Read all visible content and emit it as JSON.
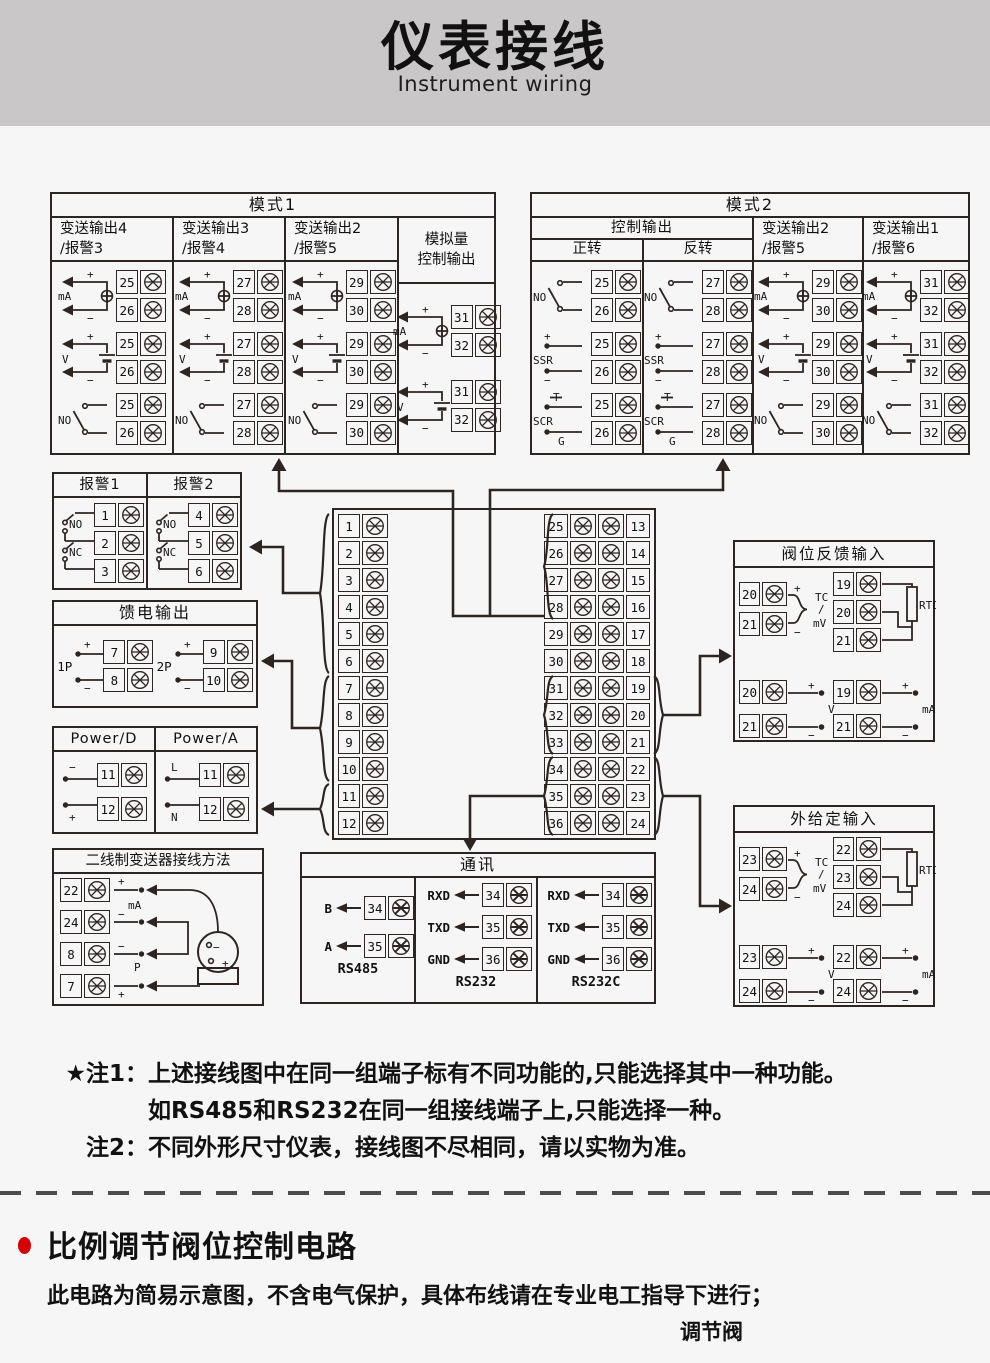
{
  "header": {
    "title": "仪表接线",
    "subtitle": "Instrument wiring"
  },
  "mode1": {
    "title": "模式1",
    "columns": [
      {
        "line1": "变送输出4",
        "line2": "/报警3",
        "cells": [
          {
            "type": "mA",
            "t": [
              "25",
              "26"
            ]
          },
          {
            "type": "V",
            "t": [
              "25",
              "26"
            ]
          },
          {
            "type": "NO",
            "t": [
              "25",
              "26"
            ]
          }
        ]
      },
      {
        "line1": "变送输出3",
        "line2": "/报警4",
        "cells": [
          {
            "type": "mA",
            "t": [
              "27",
              "28"
            ]
          },
          {
            "type": "V",
            "t": [
              "27",
              "28"
            ]
          },
          {
            "type": "NO",
            "t": [
              "27",
              "28"
            ]
          }
        ]
      },
      {
        "line1": "变送输出2",
        "line2": "/报警5",
        "cells": [
          {
            "type": "mA",
            "t": [
              "29",
              "30"
            ]
          },
          {
            "type": "V",
            "t": [
              "29",
              "30"
            ]
          },
          {
            "type": "NO",
            "t": [
              "29",
              "30"
            ]
          }
        ]
      },
      {
        "line1": "模拟量",
        "line2": "控制输出",
        "cells": [
          {
            "type": "mA",
            "t": [
              "31",
              "32"
            ]
          },
          {
            "type": "V",
            "t": [
              "31",
              "32"
            ]
          }
        ]
      }
    ]
  },
  "mode2": {
    "title": "模式2",
    "group": "控制输出",
    "columns": [
      {
        "line1": "正转",
        "cells": [
          {
            "type": "NO",
            "t": [
              "25",
              "26"
            ]
          },
          {
            "type": "SSR",
            "t": [
              "25",
              "26"
            ]
          },
          {
            "type": "SCR",
            "t": [
              "25",
              "26"
            ]
          }
        ]
      },
      {
        "line1": "反转",
        "cells": [
          {
            "type": "NO",
            "t": [
              "27",
              "28"
            ]
          },
          {
            "type": "SSR",
            "t": [
              "27",
              "28"
            ]
          },
          {
            "type": "SCR",
            "t": [
              "27",
              "28"
            ]
          }
        ]
      },
      {
        "line1": "变送输出2",
        "line2": "/报警5",
        "cells": [
          {
            "type": "mA",
            "t": [
              "29",
              "30"
            ]
          },
          {
            "type": "V",
            "t": [
              "29",
              "30"
            ]
          },
          {
            "type": "NO",
            "t": [
              "29",
              "30"
            ]
          }
        ]
      },
      {
        "line1": "变送输出1",
        "line2": "/报警6",
        "cells": [
          {
            "type": "mA",
            "t": [
              "31",
              "32"
            ]
          },
          {
            "type": "V",
            "t": [
              "31",
              "32"
            ]
          },
          {
            "type": "NO",
            "t": [
              "31",
              "32"
            ]
          }
        ]
      }
    ]
  },
  "alarm": {
    "no_label": "NO",
    "nc_label": "NC",
    "columns": [
      {
        "title": "报警1",
        "t": [
          "1",
          "2",
          "3"
        ]
      },
      {
        "title": "报警2",
        "t": [
          "4",
          "5",
          "6"
        ]
      }
    ]
  },
  "feed": {
    "title": "馈电输出",
    "groups": [
      {
        "label": "1P",
        "t": [
          "7",
          "8"
        ]
      },
      {
        "label": "2P",
        "t": [
          "9",
          "10"
        ]
      }
    ]
  },
  "power": {
    "columns": [
      {
        "title": "Power/D",
        "signs": [
          "−",
          "+"
        ],
        "t": [
          "11",
          "12"
        ]
      },
      {
        "title": "Power/A",
        "signs": [
          "L",
          "N"
        ],
        "t": [
          "11",
          "12"
        ]
      }
    ]
  },
  "twowire": {
    "title": "二线制变送器接线方法",
    "t": [
      "22",
      "24",
      "8",
      "7"
    ],
    "signs": [
      "+",
      "−",
      "−",
      "+"
    ],
    "labels": [
      "mA",
      "P"
    ]
  },
  "strip": {
    "left": [
      "1",
      "2",
      "3",
      "4",
      "5",
      "6",
      "7",
      "8",
      "9",
      "10",
      "11",
      "12"
    ],
    "mid": [
      "25",
      "26",
      "27",
      "28",
      "29",
      "30",
      "31",
      "32",
      "33",
      "34",
      "35",
      "36"
    ],
    "right": [
      "13",
      "14",
      "15",
      "16",
      "17",
      "18",
      "19",
      "20",
      "21",
      "22",
      "23",
      "24"
    ]
  },
  "valvefb": {
    "title": "阀位反馈输入",
    "tc": {
      "t": [
        "20",
        "21"
      ],
      "label1": "TC",
      "label2": "mV"
    },
    "rtd": {
      "t": [
        "19",
        "20",
        "21"
      ],
      "label": "RTD"
    },
    "v": {
      "t": [
        "20",
        "21"
      ],
      "label": "V"
    },
    "ma": {
      "t": [
        "19",
        "21"
      ],
      "label": "mA"
    }
  },
  "extset": {
    "title": "外给定输入",
    "tc": {
      "t": [
        "23",
        "24"
      ],
      "label1": "TC",
      "label2": "mV"
    },
    "rtd": {
      "t": [
        "22",
        "23",
        "24"
      ],
      "label": "RTD"
    },
    "v": {
      "t": [
        "23",
        "24"
      ],
      "label": "V"
    },
    "ma": {
      "t": [
        "22",
        "24"
      ],
      "label": "mA"
    }
  },
  "comm": {
    "title": "通讯",
    "groups": [
      {
        "name": "RS485",
        "pins": [
          {
            "label": "B",
            "t": "34"
          },
          {
            "label": "A",
            "t": "35"
          }
        ]
      },
      {
        "name": "RS232",
        "pins": [
          {
            "label": "RXD",
            "t": "34"
          },
          {
            "label": "TXD",
            "t": "35"
          },
          {
            "label": "GND",
            "t": "36"
          }
        ]
      },
      {
        "name": "RS232C",
        "pins": [
          {
            "label": "RXD",
            "t": "34"
          },
          {
            "label": "TXD",
            "t": "35"
          },
          {
            "label": "GND",
            "t": "36"
          }
        ]
      }
    ]
  },
  "notes": {
    "n1_prefix": "★注1：",
    "n1": "上述接线图中在同一组端子标有不同功能的,只能选择其中一种功能。",
    "n1b": "如RS485和RS232在同一组接线端子上,只能选择一种。",
    "n2_prefix": "注2：",
    "n2": "不同外形尺寸仪表，接线图不尽相同，请以实物为准。"
  },
  "section2": {
    "title": "比例调节阀位控制电路",
    "body": "此电路为简易示意图，不含电气保护，具体布线请在专业电工指导下进行；",
    "caption": "调节阀"
  },
  "colors": {
    "line": "#2d2522",
    "header_bg": "#c9c7c8",
    "page_bg": "#f7f6f6",
    "accent": "#d70000"
  }
}
